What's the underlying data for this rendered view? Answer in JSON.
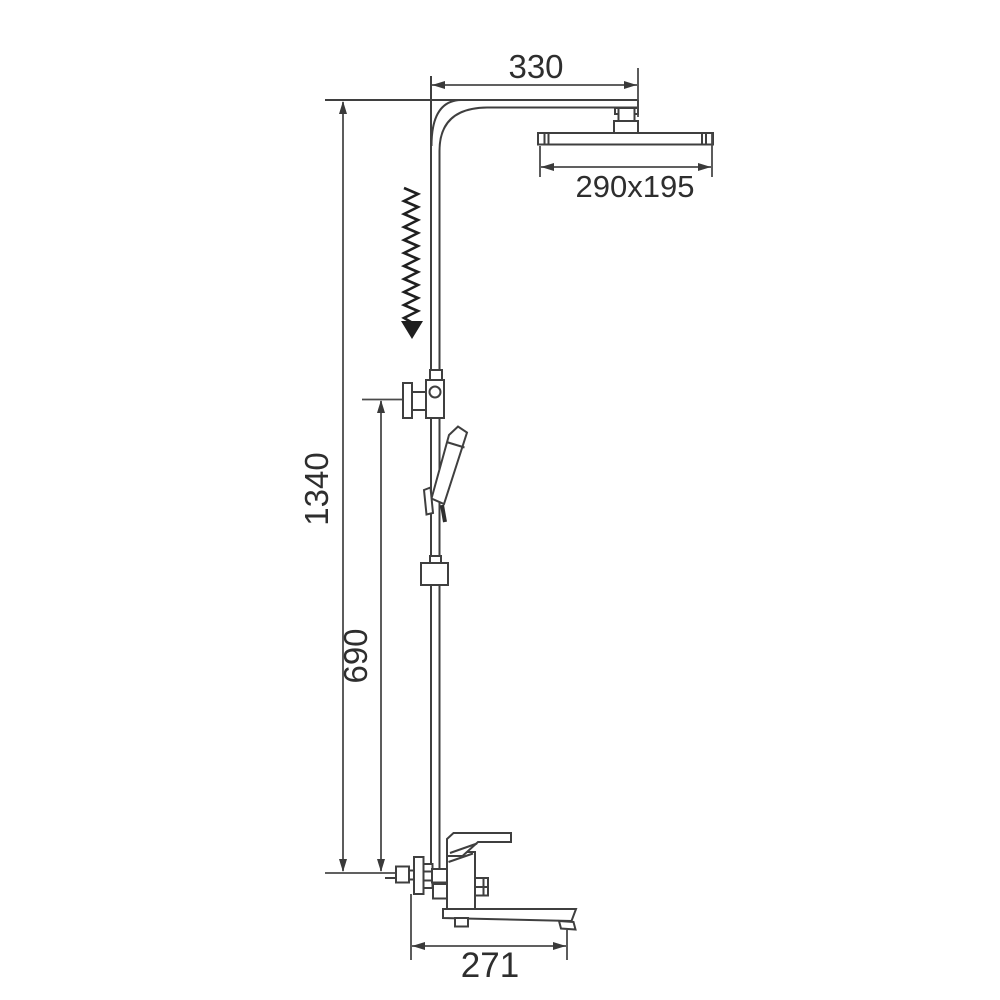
{
  "diagram": {
    "kind": "technical-dimension-drawing",
    "background_color": "#ffffff",
    "line_color": "#3f3f3f",
    "arrow_color": "#1f1f1f",
    "dimensions": {
      "arm_reach": "330",
      "head_size": "290x195",
      "total_height": "1340",
      "slide_bar_height": "690",
      "spout_reach": "271"
    }
  }
}
